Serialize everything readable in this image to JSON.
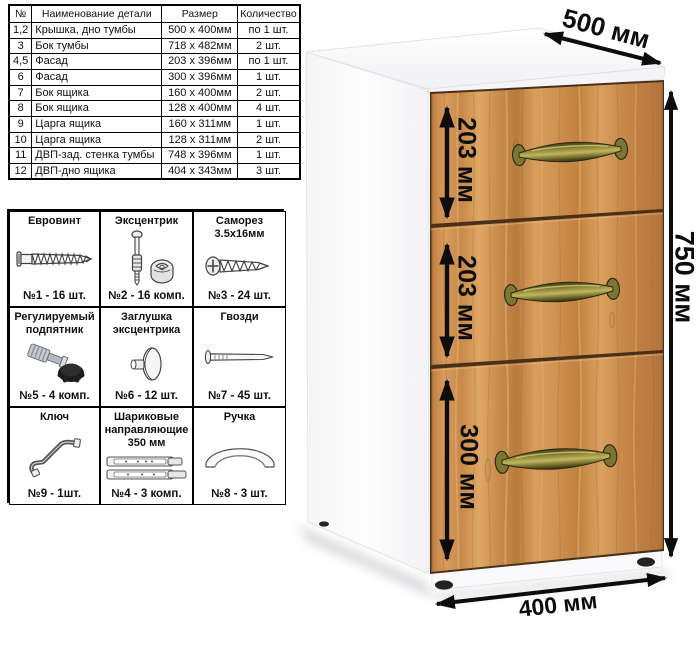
{
  "parts_table": {
    "headers": [
      "№",
      "Наименование детали",
      "Размер",
      "Количество"
    ],
    "rows": [
      [
        "1,2",
        "Крышка, дно тумбы",
        "500 х 400мм",
        "по 1 шт."
      ],
      [
        "3",
        "Бок тумбы",
        "718 х 482мм",
        "2 шт."
      ],
      [
        "4,5",
        "Фасад",
        "203 х 396мм",
        "по 1 шт."
      ],
      [
        "6",
        "Фасад",
        "300 х 396мм",
        "1 шт."
      ],
      [
        "7",
        "Бок ящика",
        "160 х 400мм",
        "2 шт."
      ],
      [
        "8",
        "Бок ящика",
        "128 х 400мм",
        "4 шт."
      ],
      [
        "9",
        "Царга ящика",
        "160 х 311мм",
        "1 шт."
      ],
      [
        "10",
        "Царга ящика",
        "128 х 311мм",
        "2 шт."
      ],
      [
        "11",
        "ДВП-зад. стенка тумбы",
        "748 х 396мм",
        "1 шт."
      ],
      [
        "12",
        "ДВП-дно ящика",
        "404 х 343мм",
        "3 шт."
      ]
    ]
  },
  "hardware": {
    "items": [
      {
        "name": "Евровинт",
        "count": "№1 - 16 шт.",
        "icon": "euro-screw-icon"
      },
      {
        "name": "Эксцентрик",
        "count": "№2 - 16 комп.",
        "icon": "cam-lock-icon"
      },
      {
        "name": "Саморез 3.5х16мм",
        "count": "№3 - 24 шт.",
        "icon": "self-tapping-screw-icon"
      },
      {
        "name": "Регулируемый подпятник",
        "count": "№5 - 4 комп.",
        "icon": "adjustable-foot-icon"
      },
      {
        "name": "Заглушка эксцентрика",
        "count": "№6 - 12 шт.",
        "icon": "cam-cap-icon"
      },
      {
        "name": "Гвозди",
        "count": "№7 - 45 шт.",
        "icon": "nail-icon"
      },
      {
        "name": "Ключ",
        "count": "№9 - 1шт.",
        "icon": "key-icon"
      },
      {
        "name": "Шариковые направляющие 350 мм",
        "count": "№4 - 3 комп.",
        "icon": "ball-slides-icon"
      },
      {
        "name": "Ручка",
        "count": "№8 - 3 шт.",
        "icon": "handle-icon"
      }
    ]
  },
  "cabinet": {
    "description": "Тумба с тремя ящиками",
    "dimensions": {
      "width_top": "500 мм",
      "height_right": "750 мм",
      "depth_bottom": "400 мм",
      "drawer1": "203 мм",
      "drawer2": "203 мм",
      "drawer3": "300 мм"
    },
    "colors": {
      "wood": "#cf9152",
      "handle_brass": "#8a8238",
      "body": "#ffffff",
      "feet": "#222222",
      "dimension_lines": "#0d0d0d"
    }
  }
}
